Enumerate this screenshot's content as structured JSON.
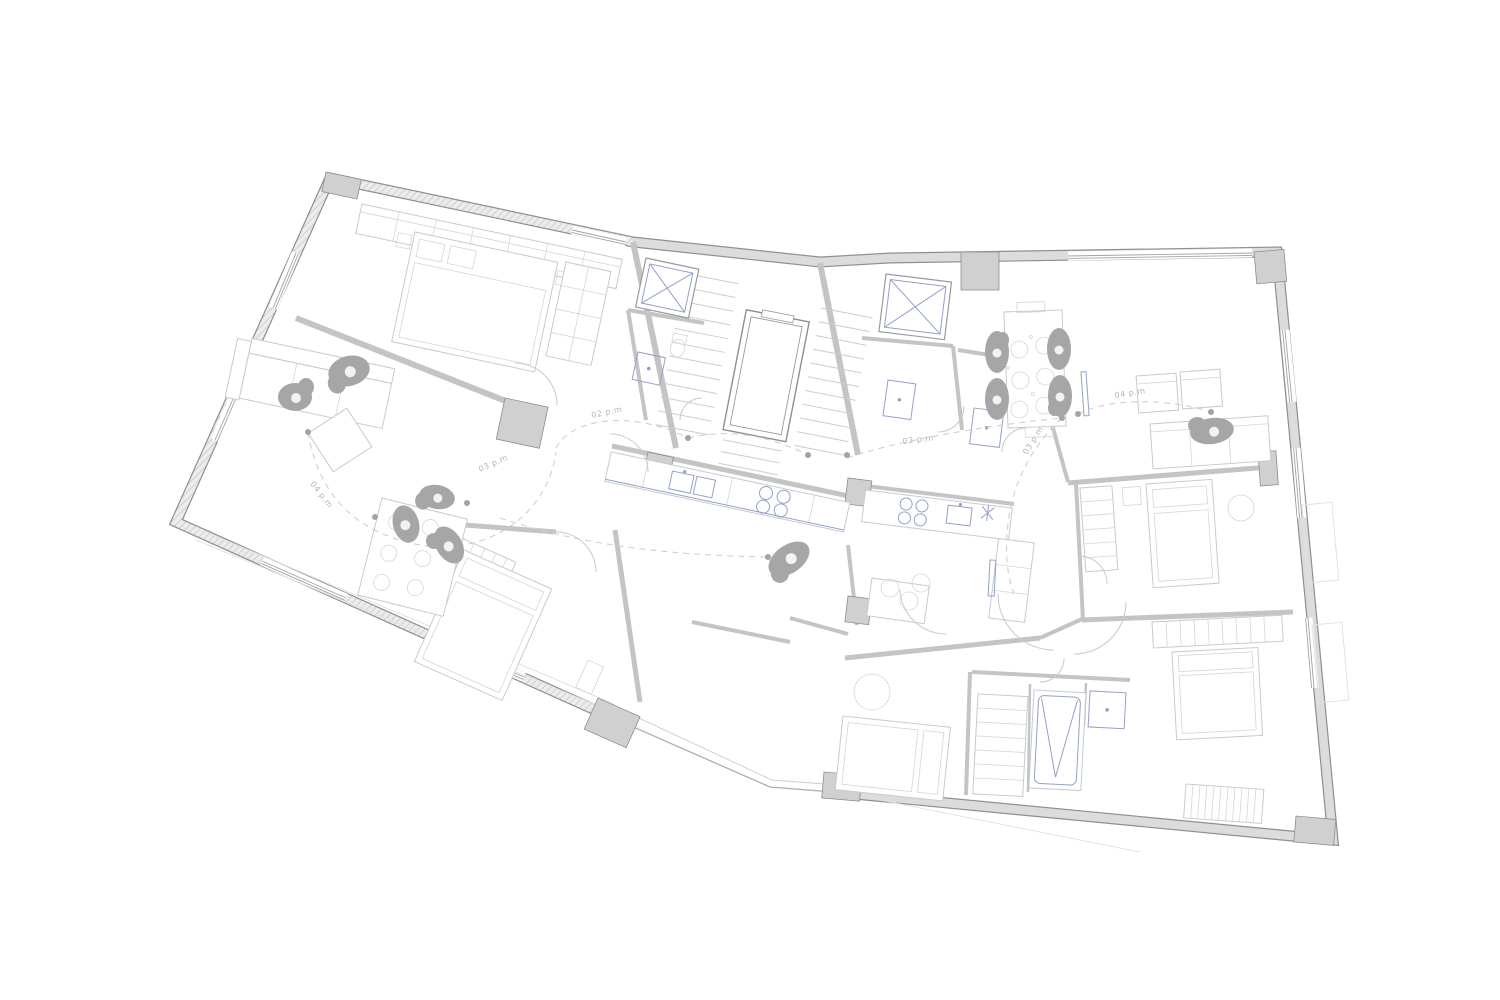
{
  "document": {
    "type": "architectural floor plan",
    "description": "Upper floor plan of an apartment building drawn as a monochrome line drawing with furniture, sanitary fixtures, stair-and-elevator core, occupant figures and dashed sun-path arcs annotated with afternoon times"
  },
  "colors": {
    "background": "#ffffff",
    "exterior_wall_fill": "#dcdcdc",
    "wall_edge": "#8f8f8f",
    "partition_wall": "#c4c4c4",
    "furniture_line": "#c6cad0",
    "fixture_blue": "#93a0c8",
    "figure_fill": "#a6a6a6",
    "sun_path_dash": "#cfcfcf",
    "label_text": "#b4b4b4"
  },
  "sun_annotations": {
    "description": "dashed sun-path arcs with small position dots and time-of-day labels",
    "labels": [
      {
        "text": "02 p.m"
      },
      {
        "text": "04 p.m"
      },
      {
        "text": "03 p.m"
      },
      {
        "text": "02 p.m"
      },
      {
        "text": "03 p.m"
      },
      {
        "text": "04 p.m"
      }
    ]
  }
}
